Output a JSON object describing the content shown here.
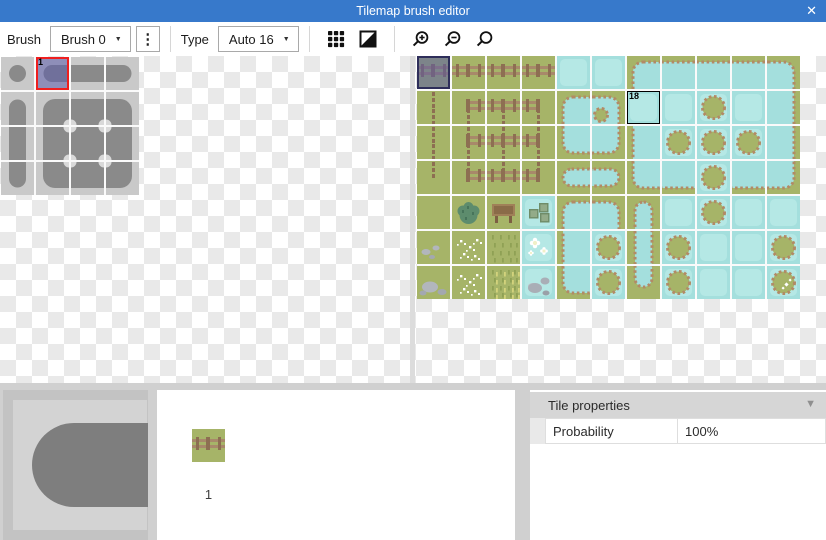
{
  "window": {
    "title": "Tilemap brush editor",
    "close_icon": "✕"
  },
  "toolbar": {
    "brush_label": "Brush",
    "brush_value": "Brush 0",
    "menu_icon": "⋮",
    "type_label": "Type",
    "type_value": "Auto 16",
    "caret_icon": "▼",
    "icon_names": [
      "grid-view-icon",
      "transparency-icon",
      "zoom-in-icon",
      "zoom-out-icon",
      "zoom-reset-icon"
    ]
  },
  "colors": {
    "titlebar": "#3779cb",
    "grass": "#a6b468",
    "water": "#a4dfdd",
    "water_light": "#b5e8e5",
    "fence_rail": "#a8896a",
    "fence_post": "#8d6f52",
    "pond_edge": "#b28a66",
    "brush_bg": "#c9c9c9",
    "brush_shape": "#8a8a8a",
    "brush_dot": "#d9d9d9",
    "selection_red": "#ef1f1f",
    "selection_navy": "#2e2e5a",
    "selection_overlay": "rgba(88,88,170,0.52)"
  },
  "brush_panel": {
    "grid": [
      [
        "dot",
        "cap-l",
        "bar-h",
        "cap-r"
      ],
      [
        "cap-t",
        "blob-tl",
        "blob-t",
        "blob-tr"
      ],
      [
        "bar-v",
        "blob-l",
        "blob-c",
        "blob-r"
      ],
      [
        "cap-b",
        "blob-bl",
        "blob-b",
        "blob-br"
      ]
    ],
    "selected": {
      "row": 0,
      "col": 1,
      "label": "1"
    }
  },
  "tileset_panel": {
    "grid": [
      [
        "fence-h",
        "fence-h",
        "fence-h",
        "fence-h",
        "water",
        "water",
        "pond-tl",
        "pond-t",
        "pond-t",
        "pond-t",
        "pond-tr"
      ],
      [
        "fence-v",
        "fence-ctl",
        "fence-et",
        "fence-ctr",
        "pond-tl",
        "pond-tr-isl",
        "water",
        "water",
        "island",
        "water",
        "pond-r"
      ],
      [
        "fence-v",
        "fence-el",
        "fence-c",
        "fence-er",
        "pond-bl",
        "pond-br",
        "pond-l",
        "island",
        "island",
        "island",
        "pond-r"
      ],
      [
        "fence-vb",
        "fence-cbl",
        "fence-eb",
        "fence-cbr",
        "pill-l",
        "pill-r",
        "pond-bl",
        "pond-b",
        "island",
        "pond-b",
        "pond-br"
      ],
      [
        "grass",
        "bush",
        "sign",
        "crates",
        "pond-tl",
        "pond-tr",
        "pillv-t",
        "water",
        "island",
        "water",
        "water"
      ],
      [
        "rocks",
        "flowers",
        "grasstex",
        "waterflowers",
        "pond-l",
        "island",
        "pillv-m",
        "island",
        "water",
        "water",
        "island"
      ],
      [
        "rocks-lg",
        "flowers",
        "grasstex2",
        "water-rocks",
        "pond-bl",
        "island",
        "pillv-b",
        "island",
        "water",
        "water",
        "island-sparkle"
      ]
    ],
    "selected": {
      "row": 0,
      "col": 0
    },
    "tagged": {
      "row": 1,
      "col": 6,
      "label": "18"
    }
  },
  "bottom": {
    "preview": {
      "tile": "cap-l"
    },
    "list": {
      "items": [
        {
          "label": "1",
          "tile": "fence-h"
        }
      ]
    },
    "properties": {
      "title": "Tile properties",
      "collapse_icon": "▼",
      "rows": [
        {
          "name": "Probability",
          "value": "100%"
        }
      ]
    }
  }
}
